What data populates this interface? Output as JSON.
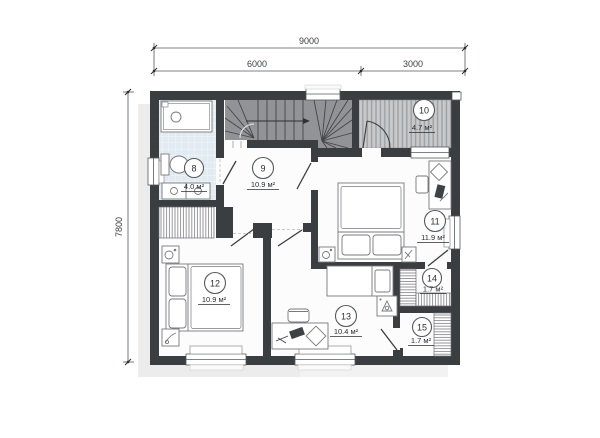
{
  "dims": {
    "total": "9000",
    "left": "6000",
    "right": "3000",
    "side": "7800"
  },
  "rooms": [
    {
      "number": "8",
      "area": "4.0 м²"
    },
    {
      "number": "9",
      "area": "10.9 м²"
    },
    {
      "number": "10",
      "area": "4.7 м²"
    },
    {
      "number": "11",
      "area": "11.9 м²"
    },
    {
      "number": "12",
      "area": "10.9 м²"
    },
    {
      "number": "13",
      "area": "10.4 м²"
    },
    {
      "number": "14",
      "area": "1.7 м²"
    },
    {
      "number": "15",
      "area": "1.7 м²"
    }
  ],
  "colors": {
    "wall": "#3b3e41",
    "floor": "#fcfcfc",
    "stairs": "#919396",
    "balcony_floor": "#c7c9cb",
    "bath_tile": "#e2ebf2",
    "shadow": "#ececec"
  }
}
